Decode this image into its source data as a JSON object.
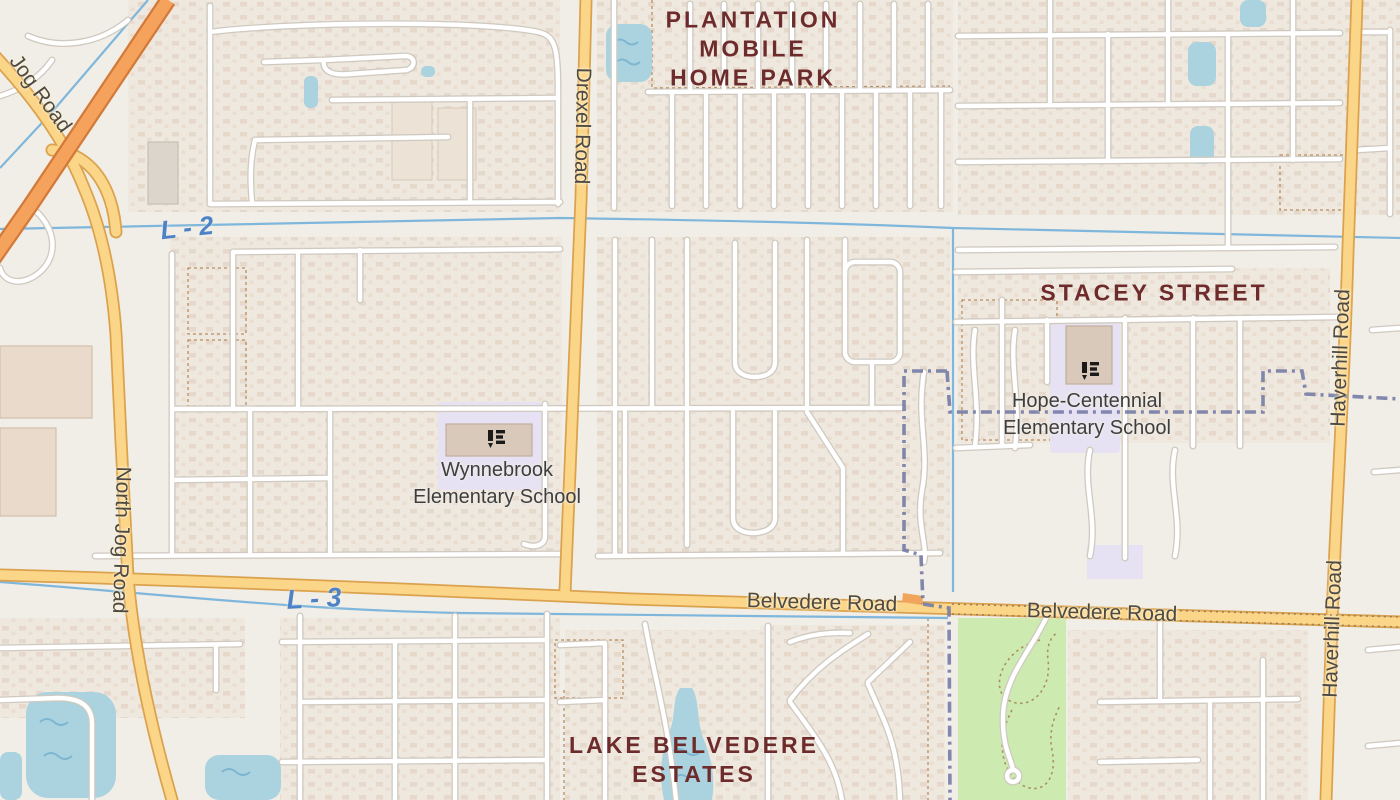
{
  "map": {
    "place_labels": {
      "plantation": {
        "line1": "PLANTATION",
        "line2": "MOBILE",
        "line3": "HOME PARK"
      },
      "stacey": "STACEY STREET",
      "lake_belvedere": {
        "line1": "LAKE BELVEDERE",
        "line2": "ESTATES"
      }
    },
    "school_labels": {
      "wynnebrook": {
        "line1": "Wynnebrook",
        "line2": "Elementary School"
      },
      "hope_centennial": {
        "line1": "Hope-Centennial",
        "line2": "Elementary School"
      }
    },
    "road_labels": {
      "drexel": "Drexel Road",
      "north_jog": "North Jog Road",
      "jog": "Jog Road",
      "haverhill_north": "Haverhill Road",
      "haverhill_south": "Haverhill Road",
      "belvedere_west": "Belvedere Road",
      "belvedere_east": "Belvedere Road"
    },
    "water_labels": {
      "l2": "L - 2",
      "l3": "L - 3"
    },
    "colors": {
      "land": "#f1eee7",
      "residential": "#efe8df",
      "house": "#e5d8ca",
      "street_fill": "#ffffff",
      "street_casing": "#cfc9c0",
      "road_primary_fill": "#fbd588",
      "road_primary_casing": "#dba24e",
      "trunk_fill": "#f5a35c",
      "trunk_casing": "#d3793a",
      "water": "#aad3df",
      "canal": "#7fb7dc",
      "park": "#cdebb0",
      "school_ground": "#e7e2f3",
      "school_building": "#d8c9ba",
      "boundary": "#767ca6",
      "place_label": "#6d2b2b",
      "road_label": "#4e4a43",
      "water_label": "#4d82c6",
      "school_icon": "#1a1a1a"
    }
  }
}
